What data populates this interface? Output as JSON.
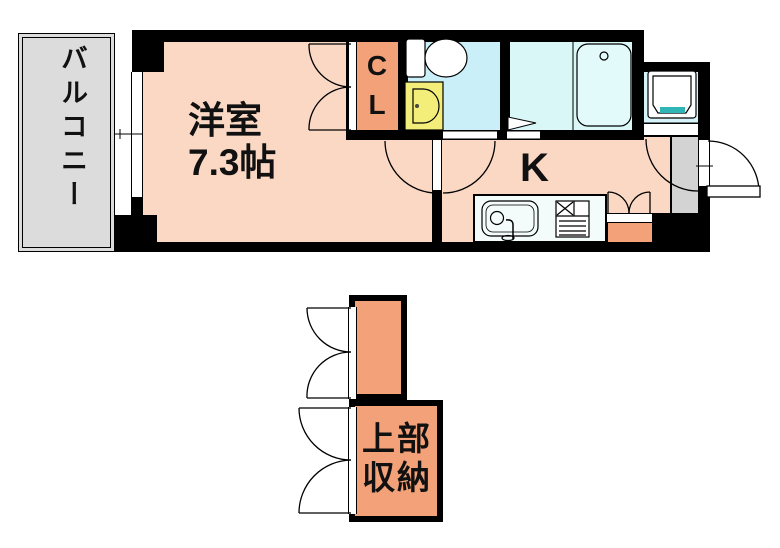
{
  "floorplan": {
    "labels": {
      "balcony": "バルコニー",
      "room": "洋室\n7.3帖",
      "closet": "C\nL",
      "kitchen": "K",
      "upper_storage": "上部\n収納"
    },
    "colors": {
      "wall": "#000000",
      "text": "#111111",
      "room_fill": "#FAD8C4",
      "accent_orange": "#F2A178",
      "toilet_fill": "#CBEFF8",
      "bath_fill": "#D9F7F6",
      "laundry_fill": "#D6F3F9",
      "tub_fill": "#E2FBFA",
      "basin_yellow": "#F3EE79",
      "machine_teal": "#2FB5B5",
      "entry_gray": "#D3D3D3",
      "balcony_gray": "#DCDCDC",
      "counter_fill": "#F4FBFB"
    }
  }
}
